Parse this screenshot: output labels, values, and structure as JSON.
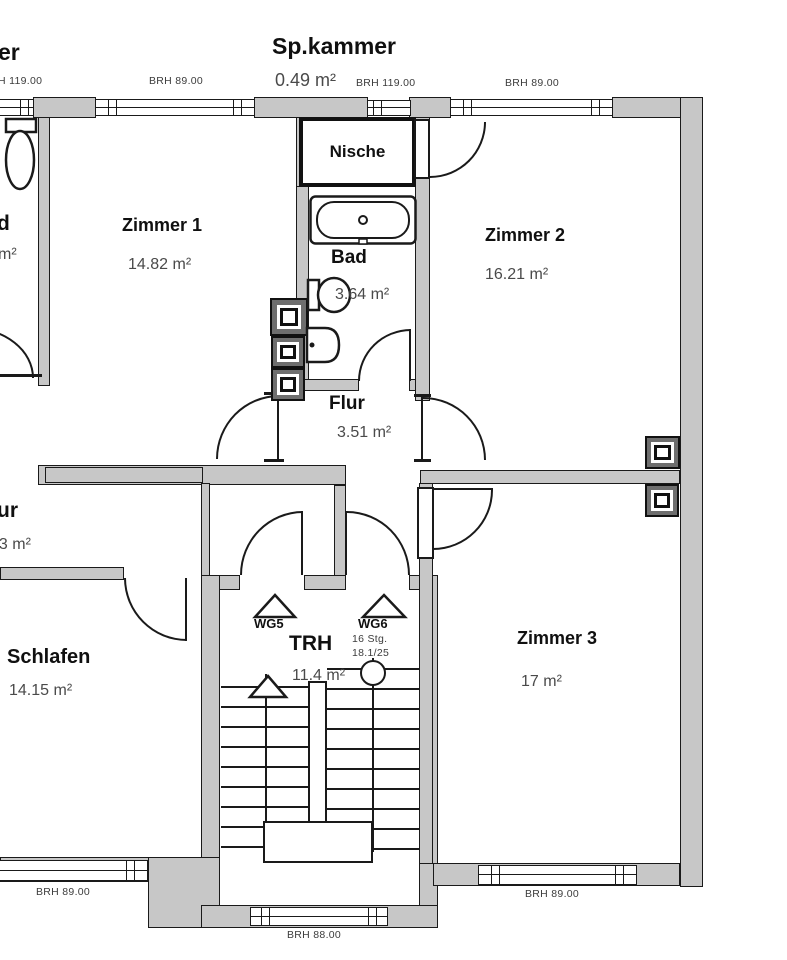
{
  "colors": {
    "wall_fill": "#c7c7c7",
    "line": "#1a1a1a",
    "area_text": "#4a4a4a",
    "room_text": "#101010"
  },
  "rooms": {
    "spkammer": {
      "name": "Sp.kammer",
      "area": "0.49 m²"
    },
    "nische": {
      "name": "Nische"
    },
    "zimmer1": {
      "name": "Zimmer 1",
      "area": "14.82 m²"
    },
    "zimmer2": {
      "name": "Zimmer 2",
      "area": "16.21 m²"
    },
    "bad": {
      "name": "Bad",
      "area": "3.64 m²"
    },
    "flur": {
      "name": "Flur",
      "area": "3.51 m²"
    },
    "schlafen": {
      "name": "Schlafen",
      "area": "14.15 m²"
    },
    "trh": {
      "name": "TRH",
      "area": "11.4 m²"
    },
    "zimmer3": {
      "name": "Zimmer 3",
      "area": "17 m²"
    }
  },
  "partials": {
    "top_left": "er",
    "left_a": "d",
    "left_a_area": "m²",
    "left_b": "ur",
    "left_b_area": "83 m²"
  },
  "brh": {
    "top_left": "H 119.00",
    "top_mid": "BRH 89.00",
    "top_nische": "BRH 119.00",
    "top_right": "BRH 89.00",
    "bottom_left": "BRH 89.00",
    "bottom_right": "BRH 89.00",
    "bottom_stair": "BRH 88.00"
  },
  "stairwell": {
    "unit_left": "WG5",
    "unit_right": "WG6",
    "steps_note": "16 Stg.",
    "ratio_note": "18.1/25"
  }
}
